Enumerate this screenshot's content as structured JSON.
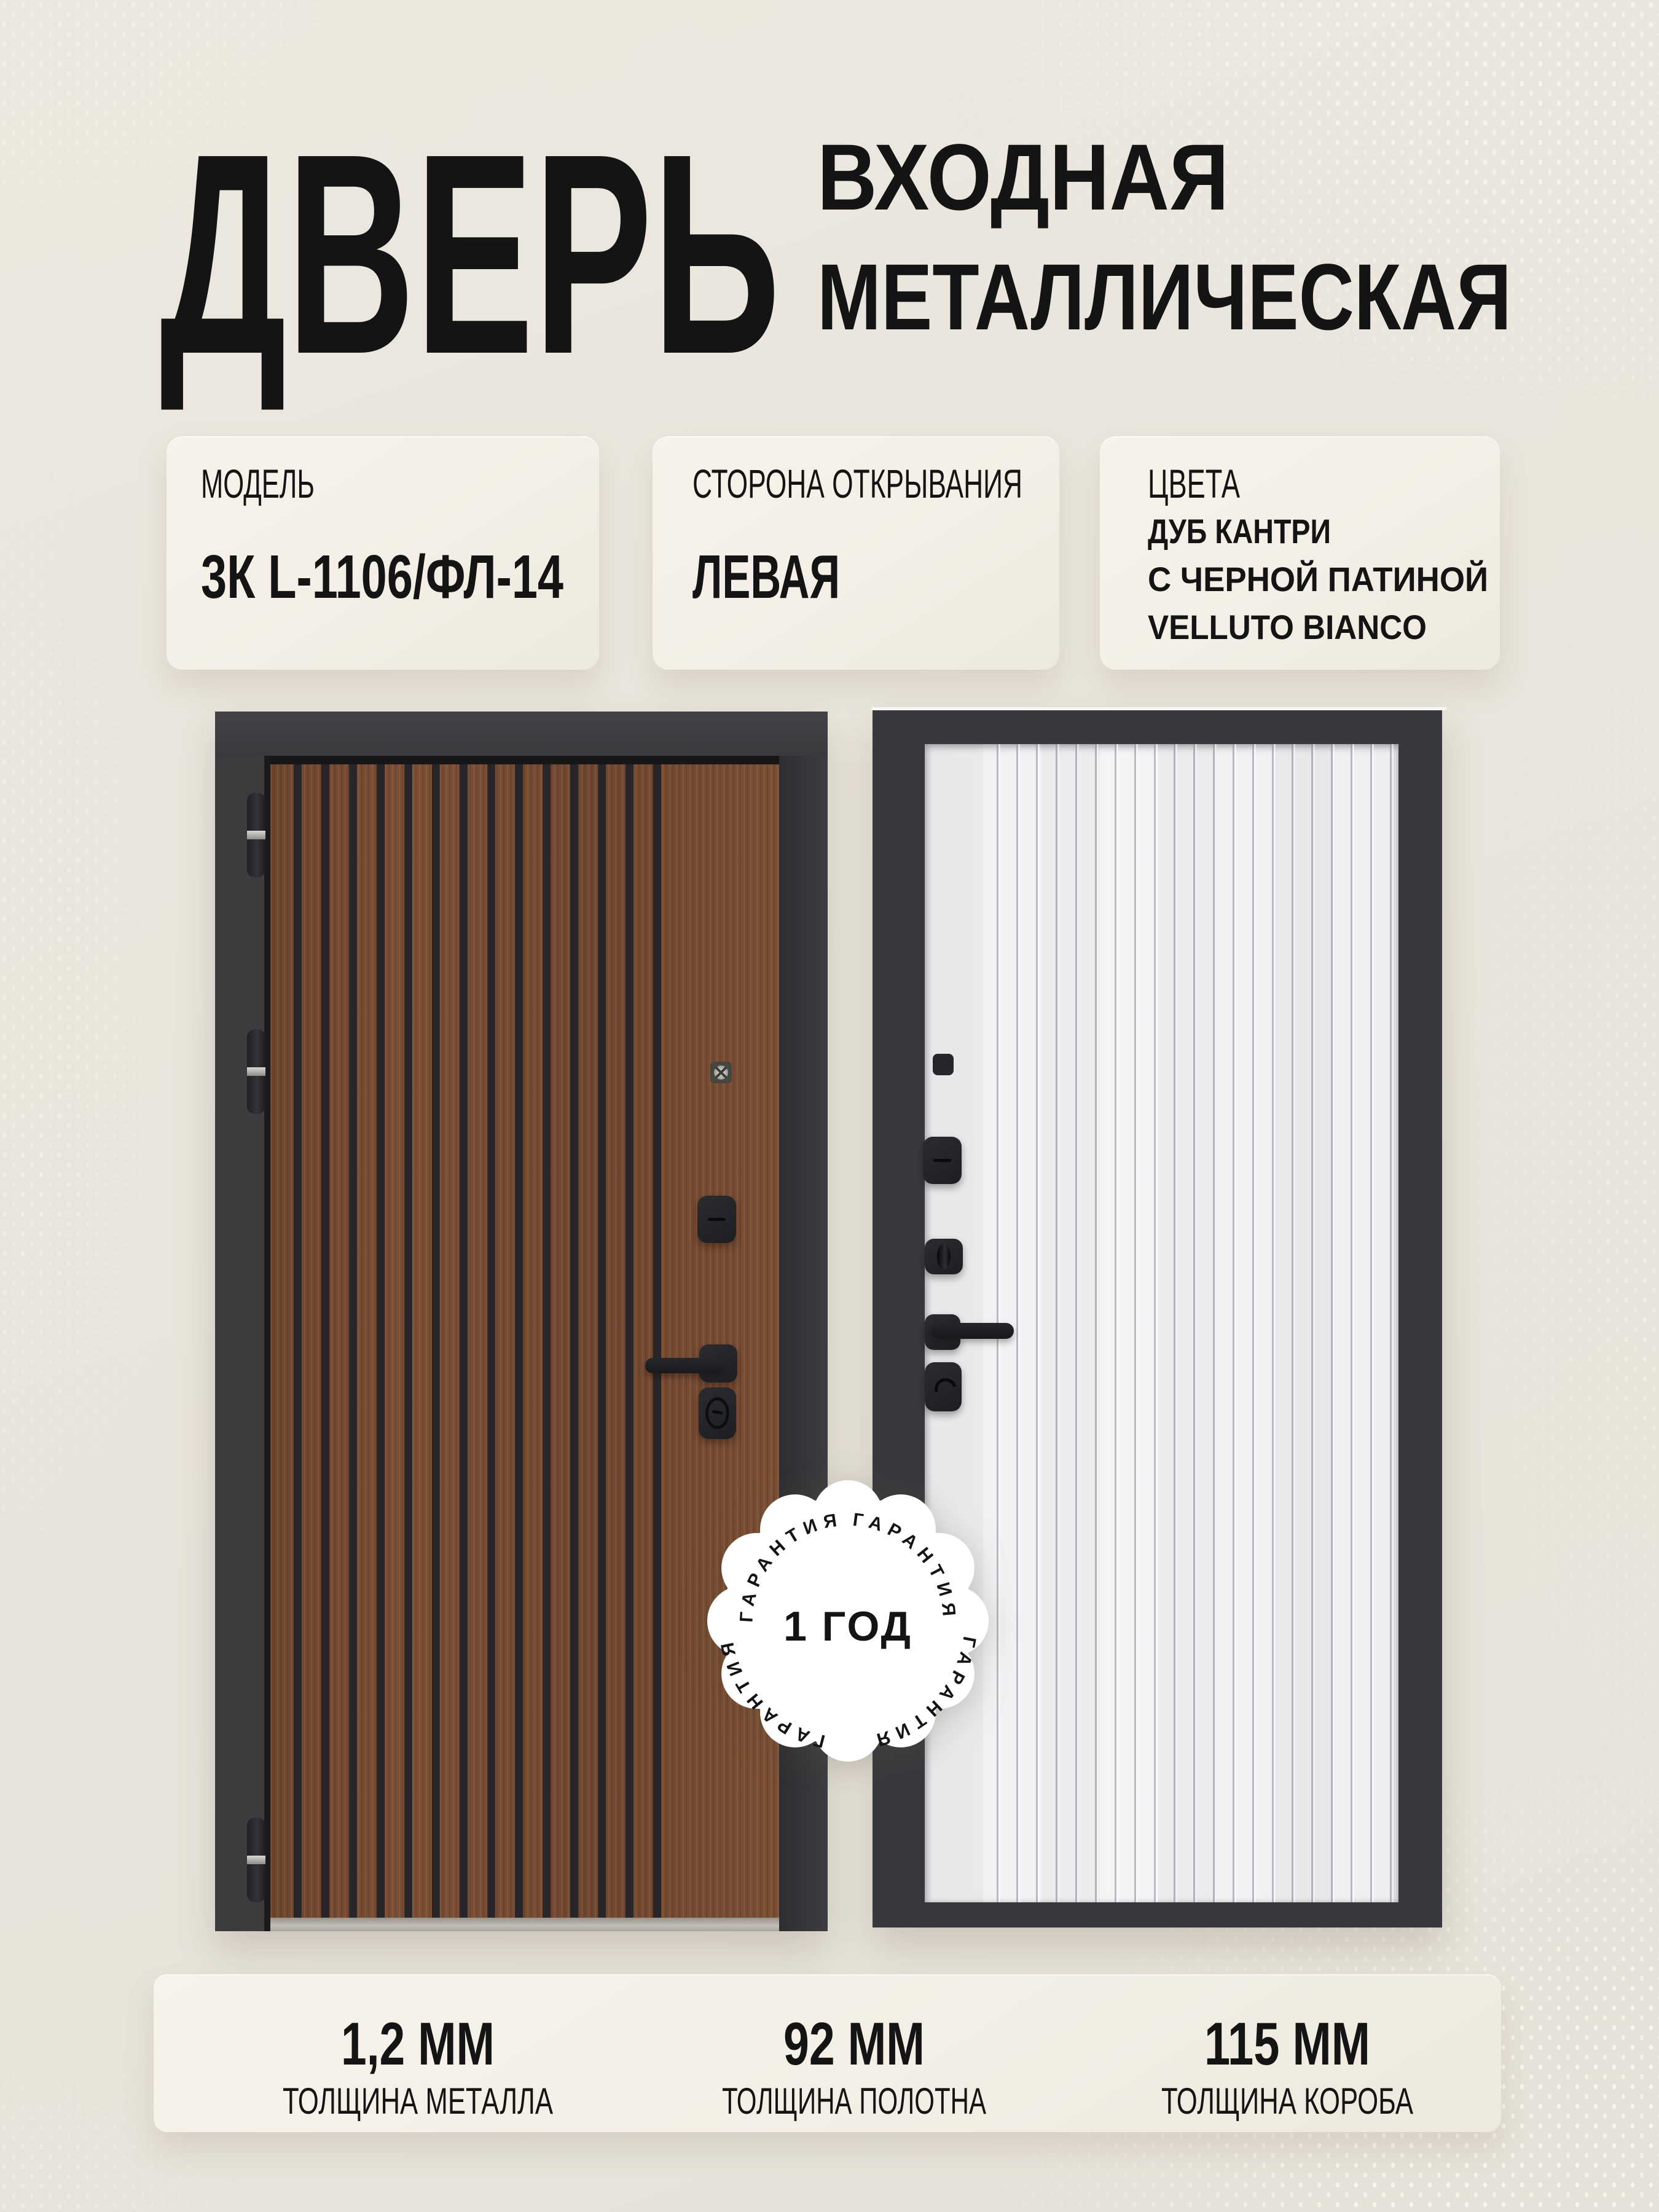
{
  "title": {
    "main": "ДВЕРЬ",
    "line1": "ВХОДНАЯ",
    "line2": "МЕТАЛЛИЧЕСКАЯ"
  },
  "info_cards": [
    {
      "label": "МОДЕЛЬ",
      "value": "3К L-1106/ФЛ-14"
    },
    {
      "label": "СТОРОНА ОТКРЫВАНИЯ",
      "value": "ЛЕВАЯ"
    },
    {
      "label": "ЦВЕТА",
      "lines": [
        "ДУБ КАНТРИ",
        "С ЧЕРНОЙ ПАТИНОЙ",
        "VELLUTO BIANCO"
      ]
    }
  ],
  "warranty": {
    "ring_label": "ГАРАНТИЯ",
    "center_label": "1 ГОД"
  },
  "stats": [
    {
      "value": "1,2 ММ",
      "label": "ТОЛЩИНА МЕТАЛЛА"
    },
    {
      "value": "92 ММ",
      "label": "ТОЛЩИНА ПОЛОТНА"
    },
    {
      "value": "115 ММ",
      "label": "ТОЛЩИНА КОРОБА"
    }
  ],
  "colors": {
    "background": "#e9e5dc",
    "card": "#f4f0e7",
    "text": "#141414",
    "door_frame": "#3a3b3e",
    "wood_brown": "#74492f",
    "slat_groove": "#29282b",
    "back_panel_white": "#f1f2f4",
    "panel_groove": "#c8c9cb",
    "badge_white": "#ffffff",
    "badge_text": "#4a4a4c"
  }
}
